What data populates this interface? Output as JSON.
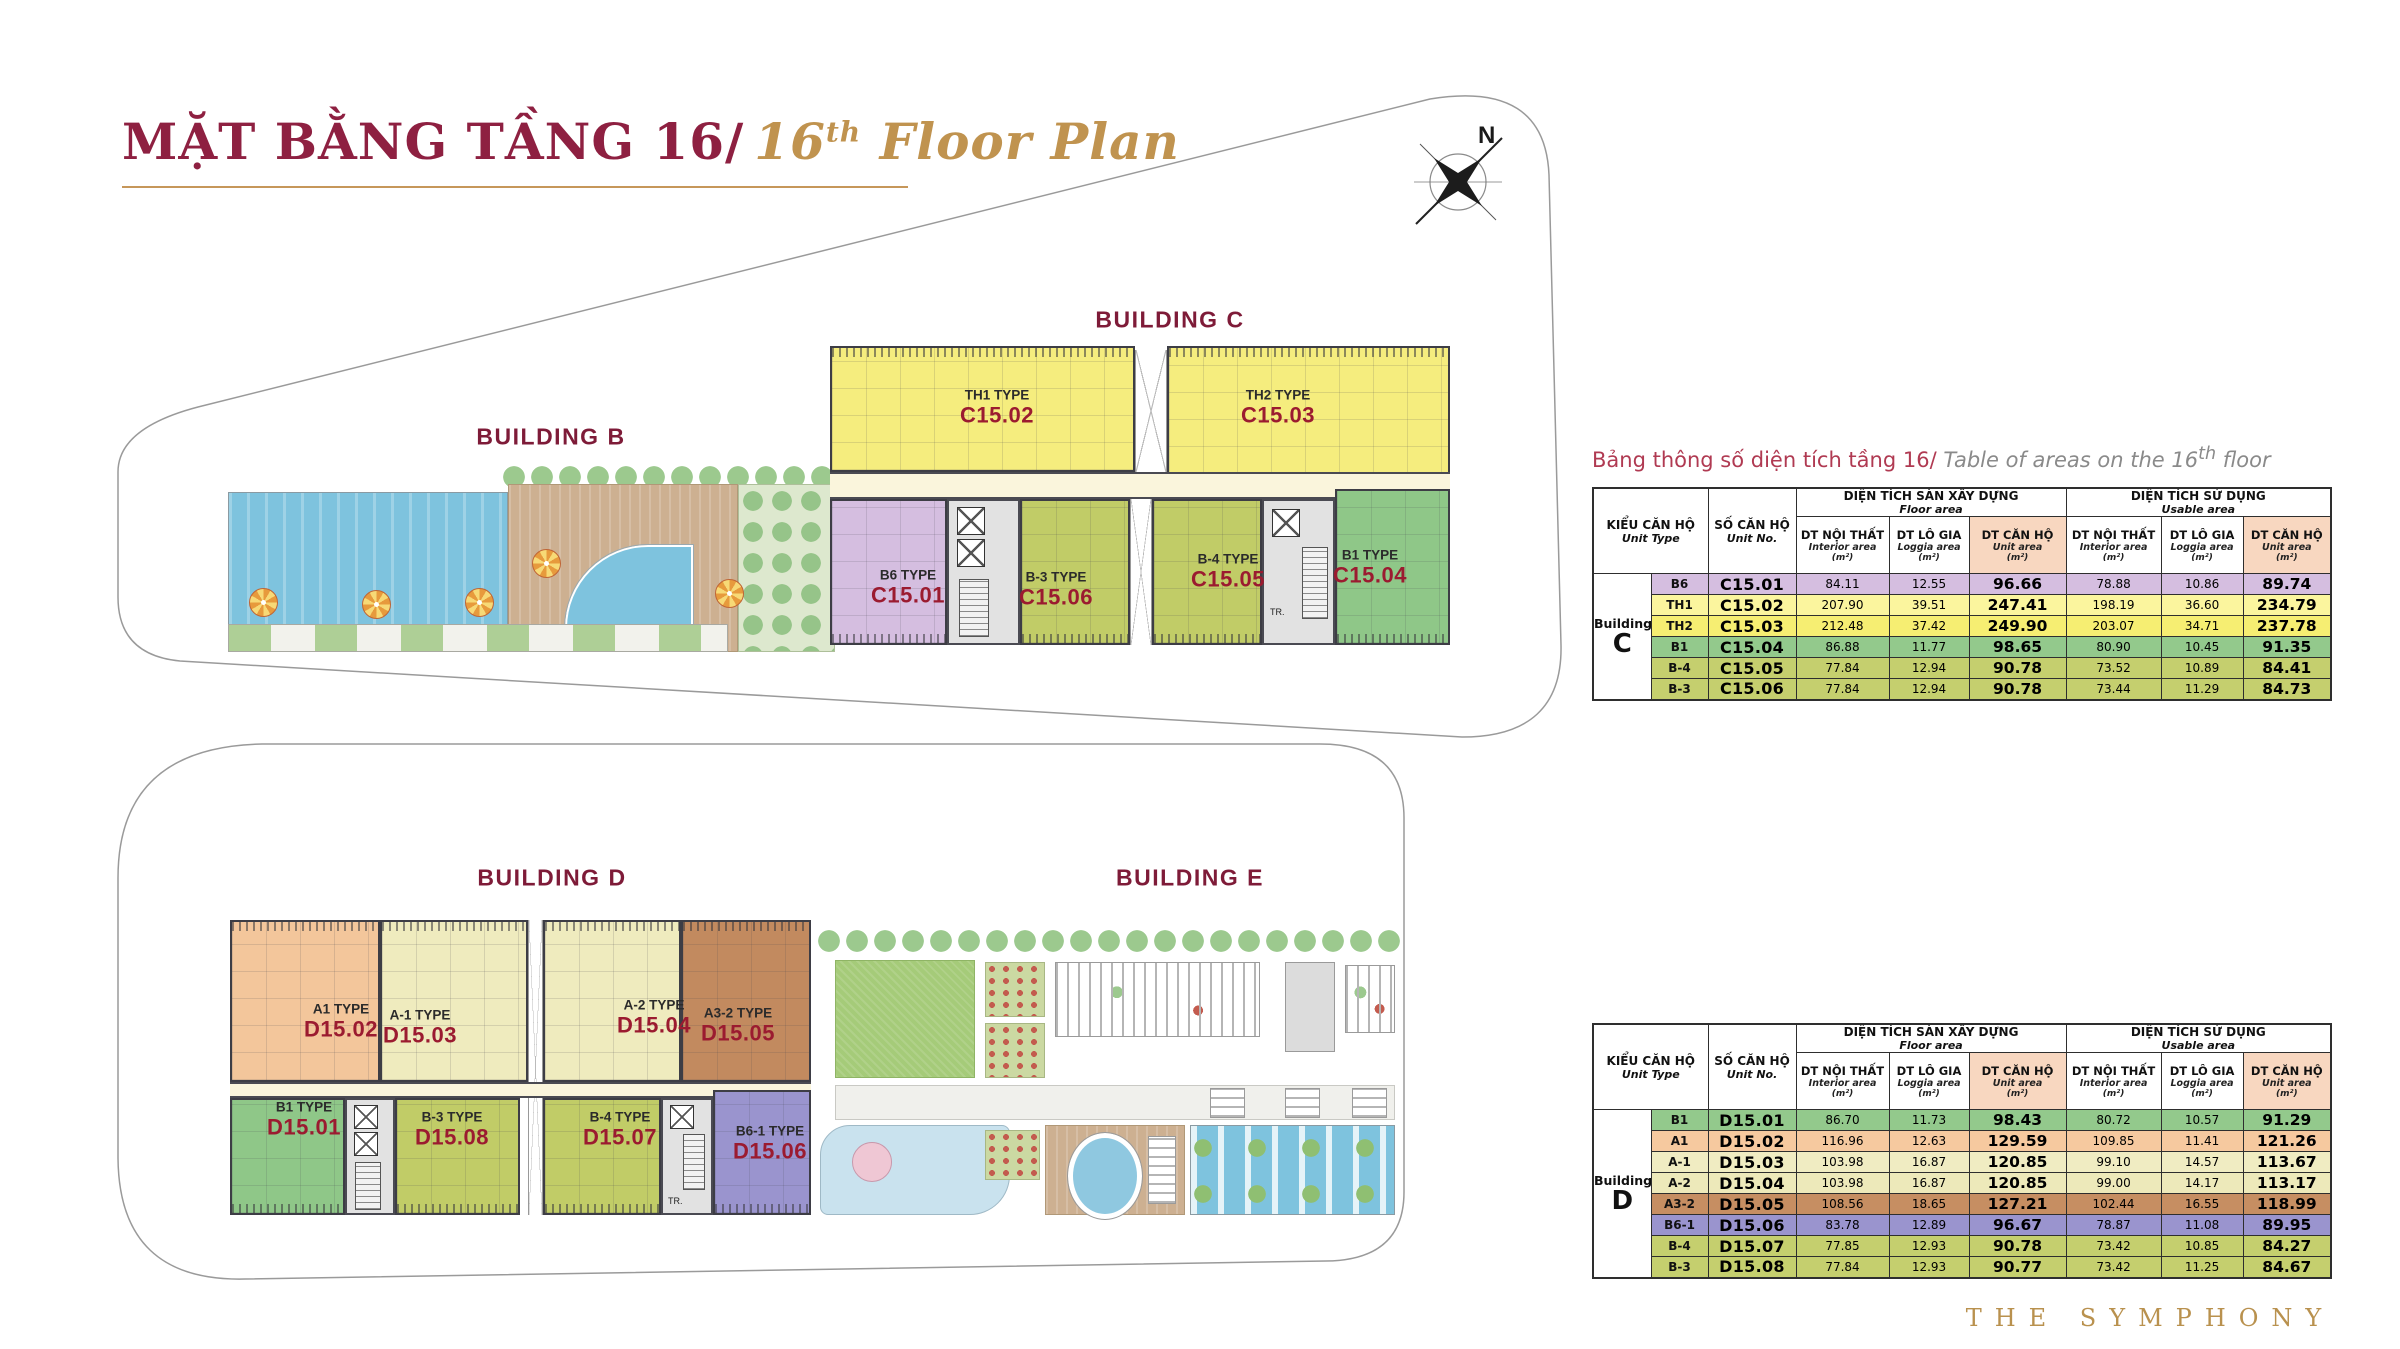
{
  "page": {
    "title_vi": "MẶT BẰNG TẦNG 16/",
    "title_en_num": "16",
    "title_en_sup": "th",
    "title_en_rest": " Floor Plan",
    "compass_label": "N",
    "brand": "THE SYMPHONY"
  },
  "palette": {
    "maroon": "#8E2041",
    "gold": "#C6975A",
    "header_highlight": "#F8D7C0",
    "corridor_cream": "#FAF5DC",
    "pool_blue": "#7EC3DE",
    "deck_tan": "#CDB091"
  },
  "plans": {
    "top": {
      "label_b": "BUILDING B",
      "label_c": "BUILDING C",
      "core_label": "TR.",
      "units": [
        {
          "type": "TH1 TYPE",
          "no": "C15.02",
          "color": "#F5ED7E"
        },
        {
          "type": "TH2 TYPE",
          "no": "C15.03",
          "color": "#F5ED7E"
        },
        {
          "type": "B6 TYPE",
          "no": "C15.01",
          "color": "#D5BEE0"
        },
        {
          "type": "B-3 TYPE",
          "no": "C15.06",
          "color": "#C1CC67"
        },
        {
          "type": "B-4 TYPE",
          "no": "C15.05",
          "color": "#C1CC67"
        },
        {
          "type": "B1 TYPE",
          "no": "C15.04",
          "color": "#8FC788"
        }
      ]
    },
    "bottom": {
      "label_d": "BUILDING D",
      "label_e": "BUILDING E",
      "core_label": "TR.",
      "units": [
        {
          "type": "A1 TYPE",
          "no": "D15.02",
          "color": "#F3C69B"
        },
        {
          "type": "A-1 TYPE",
          "no": "D15.03",
          "color": "#EFEBBE"
        },
        {
          "type": "A-2 TYPE",
          "no": "D15.04",
          "color": "#EFEBBE"
        },
        {
          "type": "A3-2 TYPE",
          "no": "D15.05",
          "color": "#C28A5F"
        },
        {
          "type": "B1 TYPE",
          "no": "D15.01",
          "color": "#8FC788"
        },
        {
          "type": "B-3 TYPE",
          "no": "D15.08",
          "color": "#C1CC67"
        },
        {
          "type": "B-4 TYPE",
          "no": "D15.07",
          "color": "#C1CC67"
        },
        {
          "type": "B6-1 TYPE",
          "no": "D15.06",
          "color": "#9A94CE"
        }
      ]
    }
  },
  "table_header": {
    "unit_type_vi": "KIỂU CĂN HỘ",
    "unit_type_en": "Unit Type",
    "unit_no_vi": "SỐ CĂN HỘ",
    "unit_no_en": "Unit No.",
    "group1_vi": "DIỆN TÍCH SÀN XÂY DỰNG",
    "group1_en": "Floor area",
    "group2_vi": "DIỆN TÍCH SỬ DỤNG",
    "group2_en": "Usable area",
    "sub": [
      {
        "vi": "DT NỘI THẤT",
        "en": "Interior area",
        "unit": "(m²)",
        "highlight": false
      },
      {
        "vi": "DT LÔ GIA",
        "en": "Loggia area",
        "unit": "(m²)",
        "highlight": false
      },
      {
        "vi": "DT CĂN HỘ",
        "en": "Unit area",
        "unit": "(m²)",
        "highlight": true
      }
    ]
  },
  "tables": [
    {
      "title_vi": "Bảng thông số diện tích tầng 16/",
      "title_en_pre": " Table of areas on the 16",
      "title_en_sup": "th",
      "title_en_post": " floor",
      "building_word": "Building",
      "building_letter": "C",
      "rows": [
        {
          "type": "B6",
          "no": "C15.01",
          "values": [
            "84.11",
            "12.55",
            "96.66",
            "78.88",
            "10.86",
            "89.74"
          ],
          "color": "#D5BEE0"
        },
        {
          "type": "TH1",
          "no": "C15.02",
          "values": [
            "207.90",
            "39.51",
            "247.41",
            "198.19",
            "36.60",
            "234.79"
          ],
          "color": "#FBF59E"
        },
        {
          "type": "TH2",
          "no": "C15.03",
          "values": [
            "212.48",
            "37.42",
            "249.90",
            "203.07",
            "34.71",
            "237.78"
          ],
          "color": "#F6EE72"
        },
        {
          "type": "B1",
          "no": "C15.04",
          "values": [
            "86.88",
            "11.77",
            "98.65",
            "80.90",
            "10.45",
            "91.35"
          ],
          "color": "#93C98C"
        },
        {
          "type": "B-4",
          "no": "C15.05",
          "values": [
            "77.84",
            "12.94",
            "90.78",
            "73.52",
            "10.89",
            "84.41"
          ],
          "color": "#C5CF6E"
        },
        {
          "type": "B-3",
          "no": "C15.06",
          "values": [
            "77.84",
            "12.94",
            "90.78",
            "73.44",
            "11.29",
            "84.73"
          ],
          "color": "#C5CF6E"
        }
      ]
    },
    {
      "building_word": "Building",
      "building_letter": "D",
      "rows": [
        {
          "type": "B1",
          "no": "D15.01",
          "values": [
            "86.70",
            "11.73",
            "98.43",
            "80.72",
            "10.57",
            "91.29"
          ],
          "color": "#93C98C"
        },
        {
          "type": "A1",
          "no": "D15.02",
          "values": [
            "116.96",
            "12.63",
            "129.59",
            "109.85",
            "11.41",
            "121.26"
          ],
          "color": "#F6C99F"
        },
        {
          "type": "A-1",
          "no": "D15.03",
          "values": [
            "103.98",
            "16.87",
            "120.85",
            "99.10",
            "14.57",
            "113.67"
          ],
          "color": "#F0ECC2"
        },
        {
          "type": "A-2",
          "no": "D15.04",
          "values": [
            "103.98",
            "16.87",
            "120.85",
            "99.00",
            "14.17",
            "113.17"
          ],
          "color": "#EDE9BA"
        },
        {
          "type": "A3-2",
          "no": "D15.05",
          "values": [
            "108.56",
            "18.65",
            "127.21",
            "102.44",
            "16.55",
            "118.99"
          ],
          "color": "#C68E62"
        },
        {
          "type": "B6-1",
          "no": "D15.06",
          "values": [
            "83.78",
            "12.89",
            "96.67",
            "78.87",
            "11.08",
            "89.95"
          ],
          "color": "#9A94CE"
        },
        {
          "type": "B-4",
          "no": "D15.07",
          "values": [
            "77.85",
            "12.93",
            "90.78",
            "73.42",
            "10.85",
            "84.27"
          ],
          "color": "#C5CF6E"
        },
        {
          "type": "B-3",
          "no": "D15.08",
          "values": [
            "77.84",
            "12.93",
            "90.77",
            "73.42",
            "11.25",
            "84.67"
          ],
          "color": "#C5CF6E"
        }
      ]
    }
  ]
}
